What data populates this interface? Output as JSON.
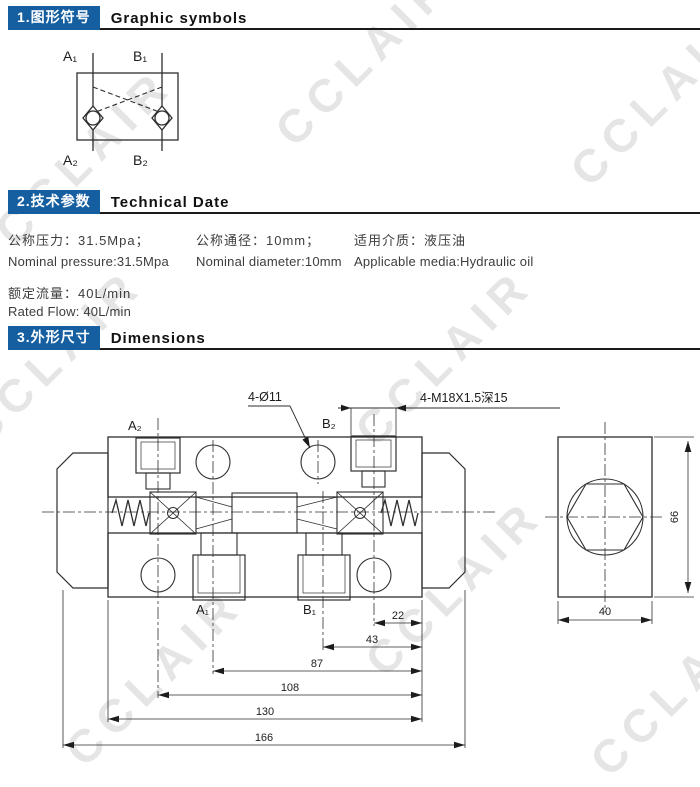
{
  "colors": {
    "header_blue": "#155fa0",
    "line_dark": "#2e2e2e",
    "watermark_gray": "#e5e5e5"
  },
  "watermark": {
    "text": "CCLAIR"
  },
  "brand": {
    "footer": "CCLair 昌林自动化"
  },
  "sections": {
    "s1": {
      "zh": "1.图形符号",
      "en": "Graphic symbols"
    },
    "s2": {
      "zh": "2.技术参数",
      "en": "Technical Date"
    },
    "s3": {
      "zh": "3.外形尺寸",
      "en": "Dimensions"
    }
  },
  "symbol": {
    "ports": {
      "a1": "A₁",
      "b1": "B₁",
      "a2": "A₂",
      "b2": "B₂"
    }
  },
  "tech": {
    "pressure_zh": "公称压力：31.5Mpa；",
    "pressure_en": "Nominal pressure:31.5Mpa",
    "diameter_zh": "公称通径：10mm；",
    "diameter_en": "Nominal diameter:10mm",
    "media_zh": "适用介质：液压油",
    "media_en": "Applicable media:Hydraulic oil",
    "flow_zh": "额定流量：40L/min",
    "flow_en": "Rated Flow: 40L/min"
  },
  "drawing": {
    "ports": {
      "a2": "A₂",
      "b2": "B₂",
      "a1": "A₁",
      "b1": "B₁"
    },
    "callout_holes": "4-Ø11",
    "callout_thread": "4-M18X1.5深15",
    "dims": [
      "22",
      "43",
      "87",
      "108",
      "130",
      "166"
    ],
    "side": {
      "width": "40",
      "height": "66"
    }
  }
}
